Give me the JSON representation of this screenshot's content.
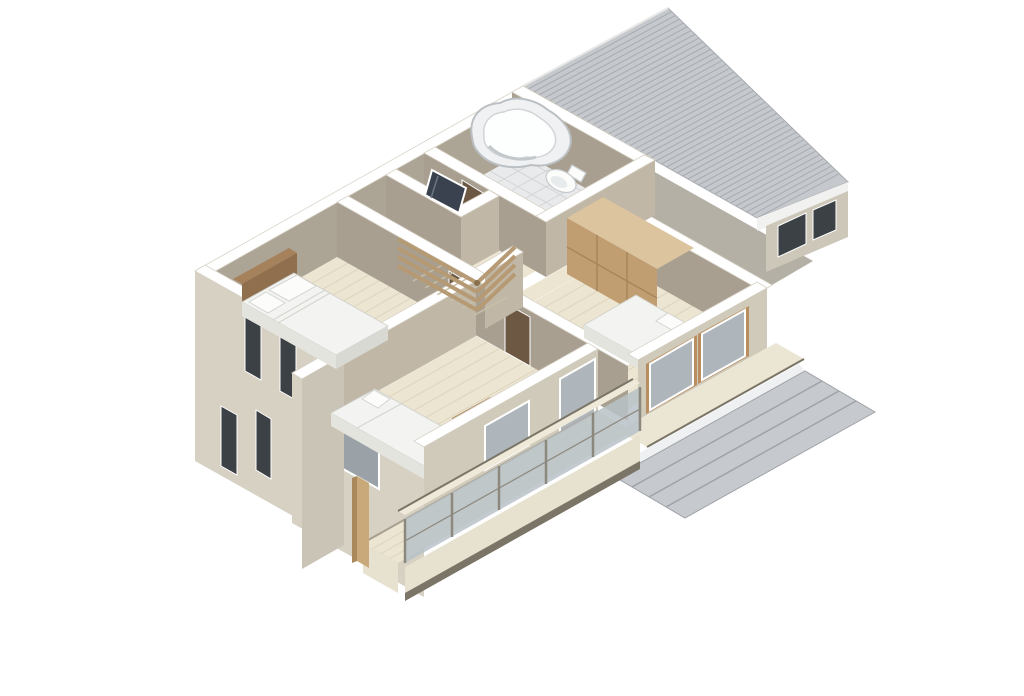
{
  "scene": {
    "title": "3D isometric cutaway floor plan rendering of a second storey",
    "type": "architectural-3d-floorplan",
    "view": "axonometric cutaway from above",
    "background": "#ffffff"
  },
  "rooms": [
    {
      "id": "bathroom",
      "label": "bathroom with corner tub and tiled floor"
    },
    {
      "id": "wc",
      "label": "small room with leaning mirror door"
    },
    {
      "id": "stair-hall",
      "label": "stair hall with wooden slat railing"
    },
    {
      "id": "bedroom-a",
      "label": "bedroom with double bed, wood headboard"
    },
    {
      "id": "bedroom-b",
      "label": "bedroom with single bed and desk"
    },
    {
      "id": "bedroom-c",
      "label": "bedroom with double bed and sliding closet"
    }
  ],
  "furniture": [
    {
      "id": "tub",
      "label": "organic-shaped bathtub"
    },
    {
      "id": "toilet",
      "label": "toilet"
    },
    {
      "id": "mirror-door",
      "label": "leaning mirror panel"
    },
    {
      "id": "bed-double-a",
      "label": "double bed with headboard and two pillows"
    },
    {
      "id": "bed-single-b",
      "label": "single bed with white duvet"
    },
    {
      "id": "desk",
      "label": "wooden desk"
    },
    {
      "id": "chair",
      "label": "blue chair"
    },
    {
      "id": "bed-double-c",
      "label": "double bed with dark headboard and two pillows"
    },
    {
      "id": "closet",
      "label": "tan sliding-door closet"
    }
  ],
  "exterior": [
    {
      "id": "main-roof",
      "label": "large gray ridged shed roof"
    },
    {
      "id": "porch-roof",
      "label": "lower gray porch roof"
    },
    {
      "id": "balcony",
      "label": "wood deck balcony with glass railing"
    },
    {
      "id": "slot-windows",
      "label": "narrow slot windows on left facade"
    }
  ],
  "colors": {
    "bg": "#ffffff",
    "top-white": "#ffffff",
    "top-outline": "#d8d3c7",
    "gap-shadow": "#b4b0a5",
    "roof-base": "#c5c8cc",
    "roof-line": "#a8acb1",
    "roof-fascia": "#f1f1ef",
    "under-eave-wall": "#ccc7b8",
    "win-dark": "#3c4146",
    "win-gray": "#9aa2a8",
    "win-glass": "#aeb6bc",
    "frame-white": "#ffffff",
    "face-nw": "#aca494",
    "face-sw-int": "#a89f90",
    "face-se-int": "#c0b7a6",
    "ext-light": "#d6d1c3",
    "ext-se": "#cfcaba",
    "ext-jog": "#c9c4b6",
    "floor-wood": "#ece5d1",
    "plank-line": "#dcd4bd",
    "stair-tread": "#c7bfa8",
    "floor-tile": "#e9eaeb",
    "tile-line": "#d3d5d6",
    "tub-rim": "#eff1f2",
    "tub-stroke": "#bbc0c4",
    "tub-inner": "#fdfefe",
    "toilet-white": "#fcfcfb",
    "fixture-stroke": "#c5cacd",
    "closet-top": "#dcc49f",
    "closet-face": "#c19e72",
    "closet-seam": "#a8865c",
    "bed-white": "#f3f3f1",
    "bed-side": "#d9d9d4",
    "bed-shadow": "#e4e4de",
    "pillow-stroke": "#d5d5d0",
    "headboard-a": "#8f6f4e",
    "headboard-a-top": "#a5815c",
    "headboard-c": "#6e553b",
    "door-brown": "#6d5943",
    "mirror-dark": "#39424e",
    "desk-top": "#b08a64",
    "desk-front": "#8f6c49",
    "desk-side": "#9a7550",
    "chair-blue": "#8a93cc",
    "rail-wood": "#b59a74",
    "glass-panel": "#b9c2c8",
    "post-gray": "#8c887d",
    "rail-top": "#efe9da",
    "deck-fascia": "#e7e1cf",
    "trim-dark": "#7b7567",
    "eave-cream": "#ebe5d3",
    "porch-gray": "#c6c9cd",
    "porch-line": "#9fa3a8",
    "porch-light": "#eef0f1",
    "wood-post": "#c9a97a",
    "wood-post-side": "#a9885c",
    "sill-wood": "#b98d5f"
  }
}
